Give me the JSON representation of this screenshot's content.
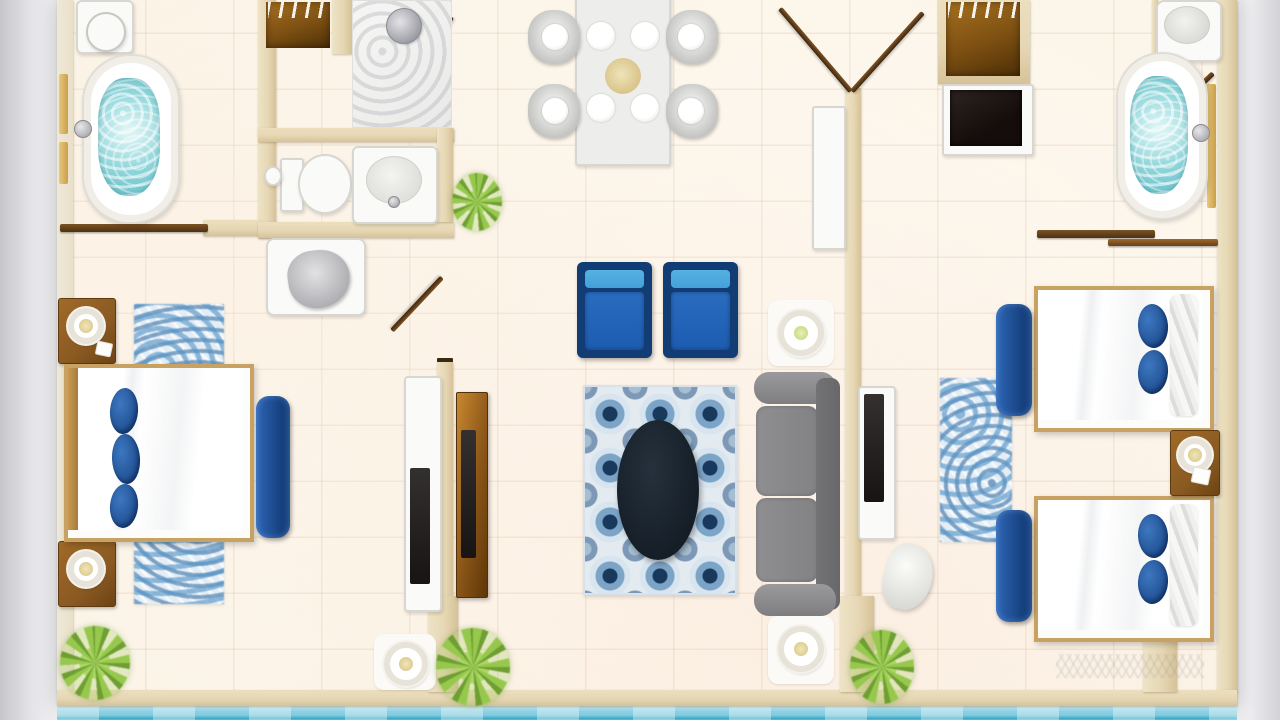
{
  "scene": {
    "type": "floor-plan",
    "description": "Top-down rendered floor plan of a two-bedroom suite with shared living/dining area, two bathrooms, shower room, closet, kitchenette and waterfront edge at bottom",
    "rooms": [
      {
        "name": "bathroom-left",
        "furniture": [
          "toilet",
          "bathtub-with-water",
          "wall-shelves",
          "sliding-wood-door"
        ]
      },
      {
        "name": "closet-top-left",
        "furniture": [
          "wardrobe-with-hangers"
        ]
      },
      {
        "name": "shower-room",
        "furniture": [
          "shower-head",
          "glass-swing-door"
        ]
      },
      {
        "name": "bathroom-middle",
        "furniture": [
          "toilet",
          "sink-counter",
          "paper-roll",
          "vanity-basin",
          "swing-door"
        ]
      },
      {
        "name": "bedroom-left",
        "furniture": [
          "double-bed",
          "three-blue-pillows",
          "textured-blue-rug",
          "nightstand-with-lamp-top",
          "nightstand-with-lamp-bottom",
          "navy-foot-bench",
          "white-dresser-tv",
          "floor-lamp",
          "potted-plant"
        ]
      },
      {
        "name": "living-dining",
        "furniture": [
          "dining-table-for-four",
          "four-gray-chairs",
          "two-blue-armchairs",
          "geometric-blue-rug",
          "dark-oval-coffee-table",
          "gray-sofa",
          "floor-lamp-north",
          "floor-lamp-south",
          "entry-console-table",
          "wood-tv-console",
          "potted-plants"
        ]
      },
      {
        "name": "entry",
        "furniture": [
          "double-swing-door"
        ]
      },
      {
        "name": "kitchenette-hall-right",
        "furniture": [
          "wardrobe-with-hangers",
          "black-stove"
        ]
      },
      {
        "name": "bathroom-right",
        "furniture": [
          "corner-sink",
          "bathtub-with-water",
          "wall-shelf",
          "two-sliding-wood-doors",
          "swing-door"
        ]
      },
      {
        "name": "bedroom-right",
        "furniture": [
          "twin-bed-north",
          "twin-bed-south",
          "blue-pillows",
          "nightstand-with-lamp",
          "two-navy-foot-benches",
          "textured-blue-rug",
          "white-dresser-tv",
          "white-chair",
          "potted-plant"
        ]
      }
    ],
    "exterior": [
      "water-band-bottom",
      "gray-photo-margins"
    ]
  },
  "colors": {
    "background": "#e9e9ec",
    "wall": "#e6d7b4",
    "door_wood": "#4f3110",
    "fixture_white": "#fafaf8",
    "fixture_border": "#d8d6d0",
    "tub_water": "#8fd5da",
    "pillow_blue": "#1c4b8c",
    "bench_navy": "#16407e",
    "armchair_navy": "#123c74",
    "armchair_blue": "#1d5cb0",
    "armchair_blue_light": "#44a0da",
    "sofa_gray": "#828284",
    "coffee_table": "#151e27",
    "bed_frame_tan": "#c7a263",
    "mattress_white": "#fcfcfa",
    "wood_brown": "#8a5a22",
    "plant_green": "#97c84e",
    "plant_green_dark": "#6f9f33",
    "water_teal": "#7fcbe0"
  }
}
